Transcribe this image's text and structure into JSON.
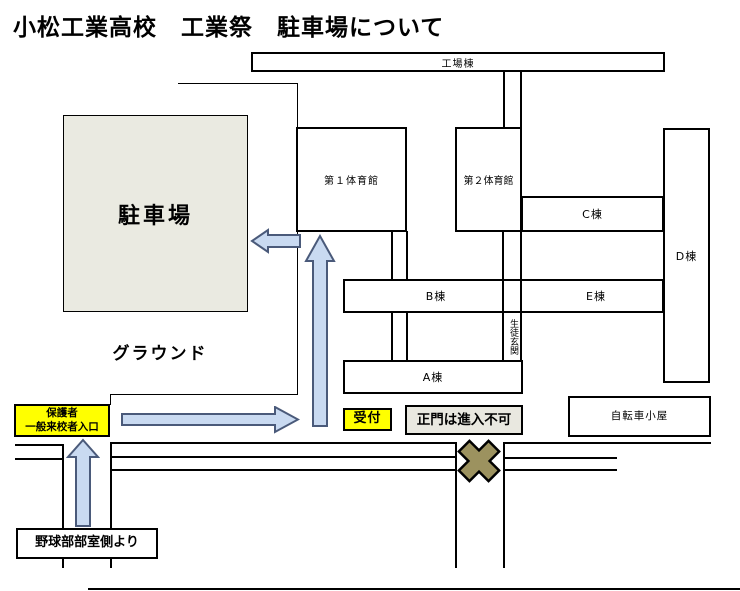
{
  "title": "小松工業高校　工業祭　駐車場について",
  "map": {
    "buildings": {
      "factory": "工場棟",
      "gym1": "第１体育館",
      "gym2": "第２体育館",
      "c": "C棟",
      "d": "D棟",
      "b": "B棟",
      "e": "E棟",
      "a": "A棟",
      "student_entrance": "生徒玄関",
      "bike_shed": "自転車小屋"
    },
    "areas": {
      "parking": "駐車場",
      "ground": "グラウンド"
    },
    "signs": {
      "visitor_entrance_line1": "保護者",
      "visitor_entrance_line2": "一般来校者入口",
      "reception": "受付",
      "main_gate": "正門は進入不可",
      "baseball_route": "野球部部室側より"
    },
    "colors": {
      "highlight_yellow": "#ffff00",
      "parking_fill": "#eaeae1",
      "notice_fill": "#e9e8e0",
      "arrow_fill": "#c9daf1",
      "arrow_stroke": "#4a5a7a",
      "no_entry_x": "#9c925f"
    }
  }
}
